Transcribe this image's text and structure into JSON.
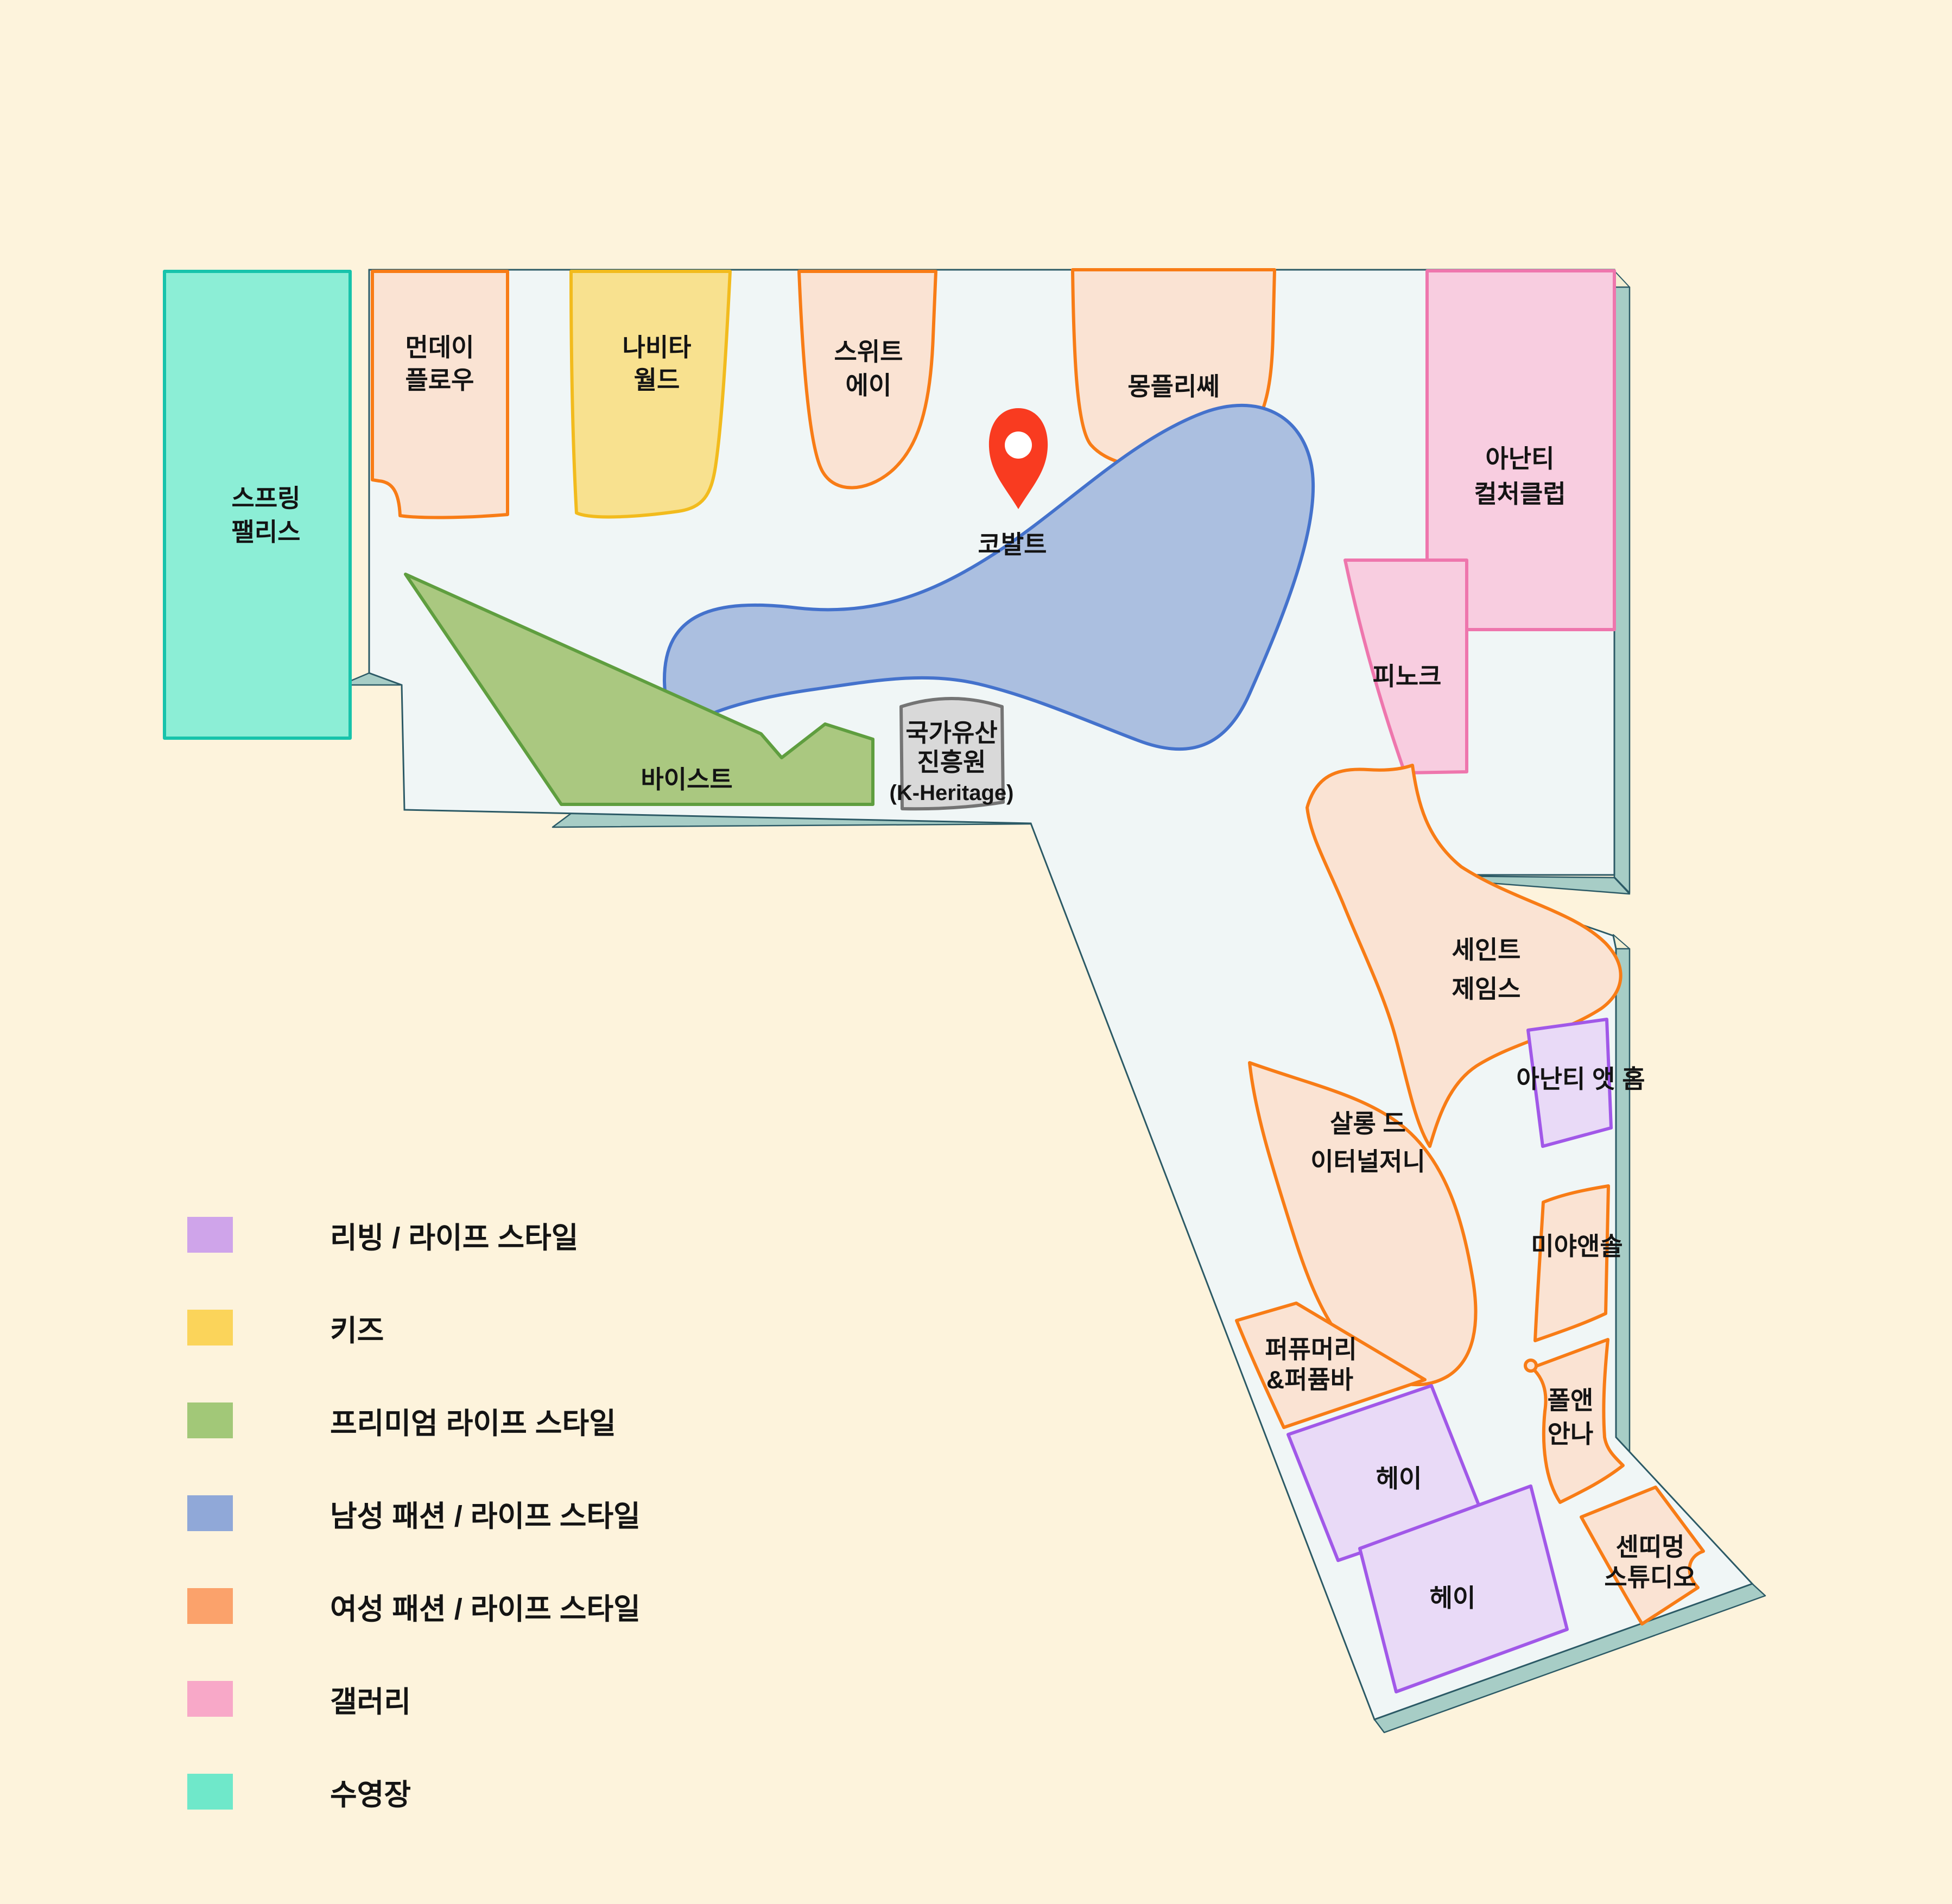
{
  "map": {
    "title": "Ananti resort shopping floor map",
    "marker": {
      "points_to": "코발트"
    },
    "shops": {
      "spring_palace": {
        "name": "스프링 팰리스",
        "lines": [
          "스프링",
          "팰리스"
        ],
        "category": "pool"
      },
      "monday_flow": {
        "name": "먼데이 플로우",
        "lines": [
          "먼데이",
          "플로우"
        ],
        "category": "womens"
      },
      "navita_world": {
        "name": "나비타 월드",
        "lines": [
          "나비타",
          "월드"
        ],
        "category": "kids"
      },
      "sweet_a": {
        "name": "스위트 에이",
        "lines": [
          "스위트",
          "에이"
        ],
        "category": "womens"
      },
      "montplisse": {
        "name": "몽플리쎄",
        "lines": [
          "몽플리쎄"
        ],
        "category": "womens"
      },
      "ananti_culture_club": {
        "name": "아난티 컬처클럽",
        "lines": [
          "아난티",
          "컬처클럽"
        ],
        "category": "gallery"
      },
      "cobalt": {
        "name": "코발트",
        "lines": [
          "코발트"
        ],
        "category": "mens"
      },
      "byst": {
        "name": "바이스트",
        "lines": [
          "바이스트"
        ],
        "category": "premium"
      },
      "k_heritage": {
        "name": "국가유산 진흥원 (K-Heritage)",
        "lines": [
          "국가유산",
          "진흥원",
          "(K-Heritage)"
        ],
        "category": "none"
      },
      "pinoke": {
        "name": "피노크",
        "lines": [
          "피노크"
        ],
        "category": "gallery"
      },
      "saint_james": {
        "name": "세인트 제임스",
        "lines": [
          "세인트",
          "제임스"
        ],
        "category": "womens"
      },
      "ananti_at_home": {
        "name": "아난티 앳 홈",
        "lines": [
          "아난티 앳 홈"
        ],
        "category": "living"
      },
      "salon_de_eternal_journey": {
        "name": "살롱 드 이터널저니",
        "lines": [
          "살롱 드",
          "이터널저니"
        ],
        "category": "womens"
      },
      "miya_and_sol": {
        "name": "미야앤솔",
        "lines": [
          "미야앤솔"
        ],
        "category": "womens"
      },
      "perfumery_perfume_bar": {
        "name": "퍼퓨머리&퍼퓸바",
        "lines": [
          "퍼퓨머리",
          "&퍼퓸바"
        ],
        "category": "womens"
      },
      "paul_and_anna": {
        "name": "폴앤 안나",
        "lines": [
          "폴앤",
          "안나"
        ],
        "category": "womens"
      },
      "hey_upper": {
        "name": "헤이",
        "lines": [
          "헤이"
        ],
        "category": "living"
      },
      "hey_lower": {
        "name": "헤이",
        "lines": [
          "헤이"
        ],
        "category": "living"
      },
      "sentiment_studio": {
        "name": "센띠멍 스튜디오",
        "lines": [
          "센띠멍",
          "스튜디오"
        ],
        "category": "womens"
      }
    }
  },
  "legend": {
    "items": [
      {
        "label": "리빙 / 라이프 스타일",
        "color": "#cfa4ea",
        "category": "living"
      },
      {
        "label": "키즈",
        "color": "#fbd45a",
        "category": "kids"
      },
      {
        "label": "프리미엄 라이프 스타일",
        "color": "#a2c878",
        "category": "premium"
      },
      {
        "label": "남성 패션 / 라이프 스타일",
        "color": "#90a8d8",
        "category": "mens"
      },
      {
        "label": "여성 패션 / 라이프 스타일",
        "color": "#fba26b",
        "category": "womens"
      },
      {
        "label": "갤러리",
        "color": "#f8a8c8",
        "category": "gallery"
      },
      {
        "label": "수영장",
        "color": "#6fe8ca",
        "category": "pool"
      }
    ]
  },
  "colors": {
    "background": "#fdf3dc",
    "floor": "#f0f6f6",
    "wall": "#a7cdc6",
    "outline": "#2c5a66",
    "pin": "#f93b20",
    "womens_fill": "#fae3d3",
    "womens_stroke": "#f87c16",
    "kids_fill": "#f8e18f",
    "kids_stroke": "#f2bb1d",
    "premium_fill": "#aac880",
    "premium_stroke": "#5f9e3f",
    "mens_fill": "#abbfe0",
    "mens_stroke": "#4472cc",
    "gallery_fill": "#f8cde0",
    "gallery_stroke": "#ee76ad",
    "living_fill": "#e9daf7",
    "living_stroke": "#a158e8",
    "pool_fill": "#8ceed6",
    "pool_stroke": "#17c3ab",
    "gray_fill": "#d9d9d9",
    "gray_stroke": "#747474"
  }
}
